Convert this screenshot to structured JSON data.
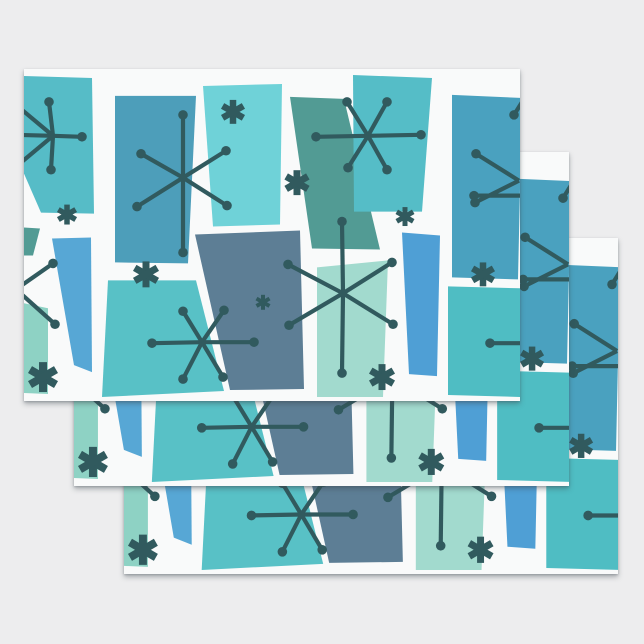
{
  "image": {
    "alt": "Three stacked flat sheets of retro mid-century modern wrapping paper with teal, blue and sage trapezoids and dark atomic starburst snowflakes on white",
    "background_color": "#ededee",
    "canvas": {
      "width": 644,
      "height": 644
    }
  },
  "sheets": {
    "paper_color": "#f9fafa",
    "shadow": "0 3px 5px rgba(60,72,78,0.38), 0 1px 2px rgba(60,72,78,0.25)",
    "stack": [
      {
        "id": "sheet-back",
        "x": 124,
        "y": 238,
        "width": 494,
        "height": 336
      },
      {
        "id": "sheet-middle",
        "x": 74,
        "y": 152,
        "width": 495,
        "height": 334
      },
      {
        "id": "sheet-front",
        "x": 24,
        "y": 69,
        "width": 496,
        "height": 332
      }
    ]
  },
  "pattern": {
    "viewbox_width": 496,
    "viewbox_height": 333,
    "ink_color": "#315a5e",
    "star_stroke_width": 4.2,
    "star_dot_radius": 4.8,
    "palette": {
      "teal": "#56bcc7",
      "steel_blue": "#4d9eba",
      "light_aqua": "#6fd2d8",
      "sage": "#529b94",
      "teal2": "#55bdc7",
      "steel_blue2": "#4aa1bf",
      "seafoam": "#8ed2c4",
      "bright_blue": "#57a7d5",
      "teal3": "#58c1c6",
      "slate_blue": "#5d7e95",
      "mint": "#a2dace",
      "bright_blue2": "#4f9fd5",
      "teal4": "#4fbdc3"
    },
    "trapezoids": [
      {
        "name": "top-left-teal",
        "color": "teal",
        "points": "0,7 68,9 70,145 17,144 0,105"
      },
      {
        "name": "top-steel-blue",
        "color": "steel_blue",
        "points": "91,27 172,27 164,195 91,194"
      },
      {
        "name": "top-light-aqua",
        "color": "light_aqua",
        "points": "179,17 258,15 256,156 189,158"
      },
      {
        "name": "slanted-sage",
        "color": "sage",
        "points": "266,28 320,30 356,181 288,180"
      },
      {
        "name": "top-teal",
        "color": "teal2",
        "points": "329,6 408,9 398,143 330,143"
      },
      {
        "name": "top-right-steel",
        "color": "steel_blue2",
        "points": "428,26 498,29 494,211 428,209"
      },
      {
        "name": "left-sage-sliver",
        "color": "sage",
        "points": "0,159 16,160 9,187 0,187"
      },
      {
        "name": "bottom-seafoam",
        "color": "seafoam",
        "points": "0,235 24,240 24,326 0,325"
      },
      {
        "name": "bottom-bright-blue",
        "color": "bright_blue",
        "points": "28,170 67,169 68,304 50,297"
      },
      {
        "name": "bottom-teal-large",
        "color": "teal3",
        "points": "84,212 172,212 200,323 78,329"
      },
      {
        "name": "bottom-slate",
        "color": "slate_blue",
        "points": "171,166 276,162 280,321 206,322"
      },
      {
        "name": "bottom-mint",
        "color": "mint",
        "points": "293,199 364,192 359,329 293,329"
      },
      {
        "name": "bottom-blue-column",
        "color": "bright_blue2",
        "points": "378,164 416,167 413,308 385,306"
      },
      {
        "name": "bottom-right-teal",
        "color": "teal4",
        "points": "424,218 498,220 498,329 424,327"
      }
    ],
    "stars": [
      {
        "name": "starburst-top-left",
        "cx": 29,
        "cy": 67,
        "spokes": [
          {
            "x": 25,
            "y": 33,
            "dot": true
          },
          {
            "x": 58,
            "y": 68,
            "dot": true
          },
          {
            "x": 27,
            "y": 101,
            "dot": true
          },
          {
            "x": -8,
            "y": 36,
            "dot": false
          },
          {
            "x": -10,
            "y": 66,
            "dot": false
          },
          {
            "x": -8,
            "y": 98,
            "dot": false
          }
        ]
      },
      {
        "name": "starburst-large-top",
        "cx": 159,
        "cy": 109,
        "spokes": [
          {
            "x": 159,
            "y": 46,
            "dot": true
          },
          {
            "x": 159,
            "y": 184,
            "dot": true
          },
          {
            "x": 117,
            "y": 85,
            "dot": true
          },
          {
            "x": 202,
            "y": 82,
            "dot": true
          },
          {
            "x": 113,
            "y": 138,
            "dot": true
          },
          {
            "x": 203,
            "y": 137,
            "dot": true
          }
        ]
      },
      {
        "name": "starburst-top-center",
        "cx": 344,
        "cy": 67,
        "spokes": [
          {
            "x": 292,
            "y": 68,
            "dot": true
          },
          {
            "x": 397,
            "y": 66,
            "dot": true
          },
          {
            "x": 323,
            "y": 33,
            "dot": true
          },
          {
            "x": 363,
            "y": 33,
            "dot": true
          },
          {
            "x": 324,
            "y": 99,
            "dot": true
          },
          {
            "x": 363,
            "y": 101,
            "dot": true
          }
        ]
      },
      {
        "name": "chevron-right-edge",
        "cx": 495,
        "cy": 112,
        "spokes": [
          {
            "x": 452,
            "y": 85,
            "dot": true
          },
          {
            "x": 451,
            "y": 134,
            "dot": true
          }
        ]
      },
      {
        "name": "pin-right-middle",
        "cx": 498,
        "cy": 127,
        "spokes": [
          {
            "x": 450,
            "y": 127,
            "dot": true
          }
        ]
      },
      {
        "name": "pin-right-top",
        "cx": 500,
        "cy": 30,
        "spokes": [
          {
            "x": 490,
            "y": 46,
            "dot": true
          }
        ]
      },
      {
        "name": "starburst-bottom-left",
        "cx": 178,
        "cy": 274,
        "spokes": [
          {
            "x": 128,
            "y": 275,
            "dot": true
          },
          {
            "x": 230,
            "y": 274,
            "dot": true
          },
          {
            "x": 159,
            "y": 243,
            "dot": true
          },
          {
            "x": 200,
            "y": 242,
            "dot": true
          },
          {
            "x": 159,
            "y": 311,
            "dot": true
          },
          {
            "x": 199,
            "y": 309,
            "dot": true
          }
        ]
      },
      {
        "name": "starburst-bottom-center",
        "cx": 319,
        "cy": 225,
        "spokes": [
          {
            "x": 318,
            "y": 153,
            "dot": true
          },
          {
            "x": 318,
            "y": 305,
            "dot": true
          },
          {
            "x": 264,
            "y": 196,
            "dot": true
          },
          {
            "x": 368,
            "y": 194,
            "dot": true
          },
          {
            "x": 265,
            "y": 257,
            "dot": true
          },
          {
            "x": 369,
            "y": 256,
            "dot": true
          }
        ]
      },
      {
        "name": "chevron-left-edge",
        "cx": -8,
        "cy": 221,
        "spokes": [
          {
            "x": 29,
            "y": 195,
            "dot": true
          },
          {
            "x": 31,
            "y": 256,
            "dot": true
          }
        ]
      },
      {
        "name": "pin-bottom-right",
        "cx": 498,
        "cy": 275,
        "spokes": [
          {
            "x": 466,
            "y": 275,
            "dot": true
          }
        ]
      }
    ],
    "asterisks": [
      {
        "name": "asterisk-below-top-left",
        "cx": 43,
        "cy": 146,
        "r": 10,
        "arm_width": 5.5
      },
      {
        "name": "asterisk-on-aqua",
        "cx": 209,
        "cy": 43,
        "r": 12,
        "arm_width": 6.5
      },
      {
        "name": "asterisk-on-sage-edge",
        "cx": 273,
        "cy": 114,
        "r": 12.5,
        "arm_width": 7
      },
      {
        "name": "asterisk-small-center",
        "cx": 381,
        "cy": 148,
        "r": 9.5,
        "arm_width": 5
      },
      {
        "name": "asterisk-mid-left",
        "cx": 122,
        "cy": 206,
        "r": 13,
        "arm_width": 7
      },
      {
        "name": "asterisk-on-slate",
        "cx": 239,
        "cy": 234,
        "r": 7.5,
        "arm_width": 4
      },
      {
        "name": "asterisk-bottom-left",
        "cx": 19,
        "cy": 309,
        "r": 15,
        "arm_width": 8
      },
      {
        "name": "asterisk-on-mint",
        "cx": 358,
        "cy": 309,
        "r": 13,
        "arm_width": 7
      },
      {
        "name": "asterisk-right-column",
        "cx": 459,
        "cy": 206,
        "r": 12,
        "arm_width": 6.5
      }
    ]
  }
}
